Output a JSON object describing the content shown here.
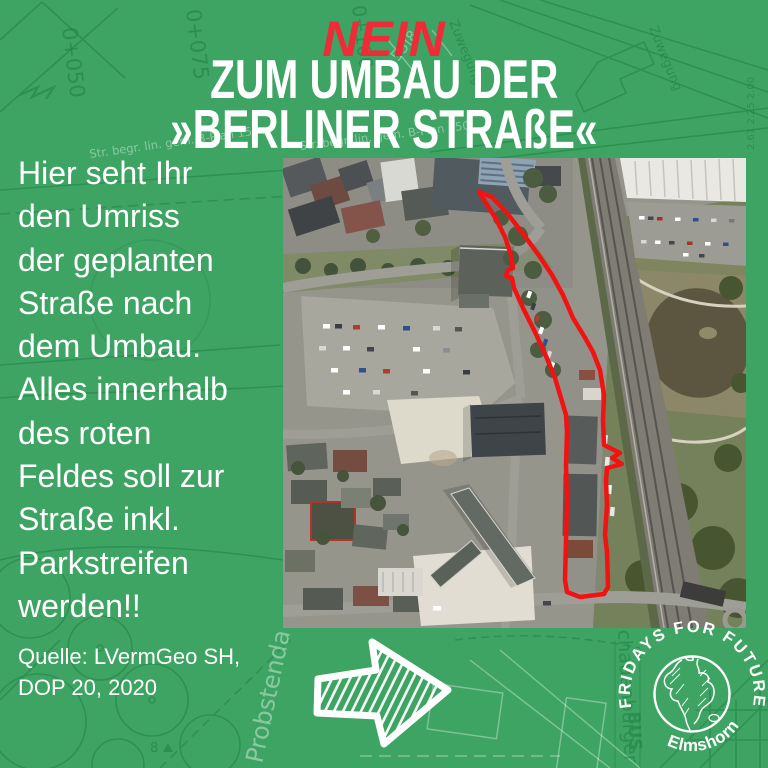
{
  "poster": {
    "headline_no": "NEIN",
    "headline_line1": "ZUM UMBAU DER",
    "headline_line2": "»BERLINER STRAßE«",
    "body_lines": [
      "Hier seht Ihr",
      "den Umriss",
      "der geplanten",
      "Straße nach",
      "dem Umbau.",
      "Alles innerhalb",
      "des roten",
      "Feldes soll zur",
      "Straße inkl.",
      "Parkstreifen",
      "werden!!"
    ],
    "source_line1": "Quelle: LVermGeo SH,",
    "source_line2": "DOP 20, 2020"
  },
  "logo": {
    "arc_text": "FRIDAYS FOR FUTURE",
    "location": "Elmshorn"
  },
  "plan": {
    "labels": [
      "0+050",
      "0+075",
      "0+100",
      "Zuwegung",
      "Zuwegung",
      "55|8",
      "Str. begr. lin. gem. B-Plan 150",
      "Probstenda",
      "chauenburger",
      "BUS",
      "8",
      "2.61  2.25  2.00"
    ]
  },
  "map": {
    "type": "aerial-photo",
    "annotation": "red outline of planned street area"
  },
  "colors": {
    "background_green": "#3da463",
    "accent_red": "#ee2b38",
    "outline_red": "#f21212",
    "text_white": "#ffffff",
    "plan_line_green": "#1d7a41"
  }
}
